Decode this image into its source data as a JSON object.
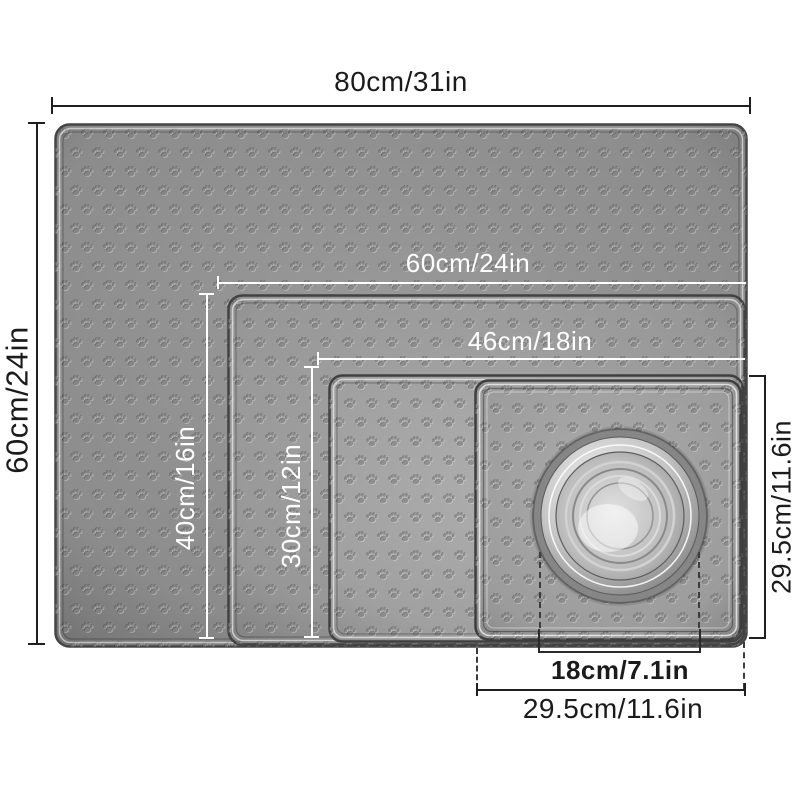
{
  "diagram": {
    "title_hint": "pet-mat-size-diagram",
    "dimensions": {
      "outer_width": "80cm/31in",
      "outer_height": "60cm/24in",
      "mat60_width": "60cm/24in",
      "mat60_height": "40cm/16in",
      "mat46_width": "46cm/18in",
      "mat46_height": "30cm/12in",
      "mat29_width": "29.5cm/11.6in",
      "mat29_height": "29.5cm/11.6in",
      "bowl_diameter": "18cm/7.1in"
    },
    "colors": {
      "background": "#ffffff",
      "dimension_line_dark": "#1f1f1f",
      "dimension_line_light": "#ffffff",
      "mat_gray": "#8c8c8c",
      "mat_gray_light": "#a0a0a0",
      "bowl_steel": "#c2c2c2"
    }
  }
}
